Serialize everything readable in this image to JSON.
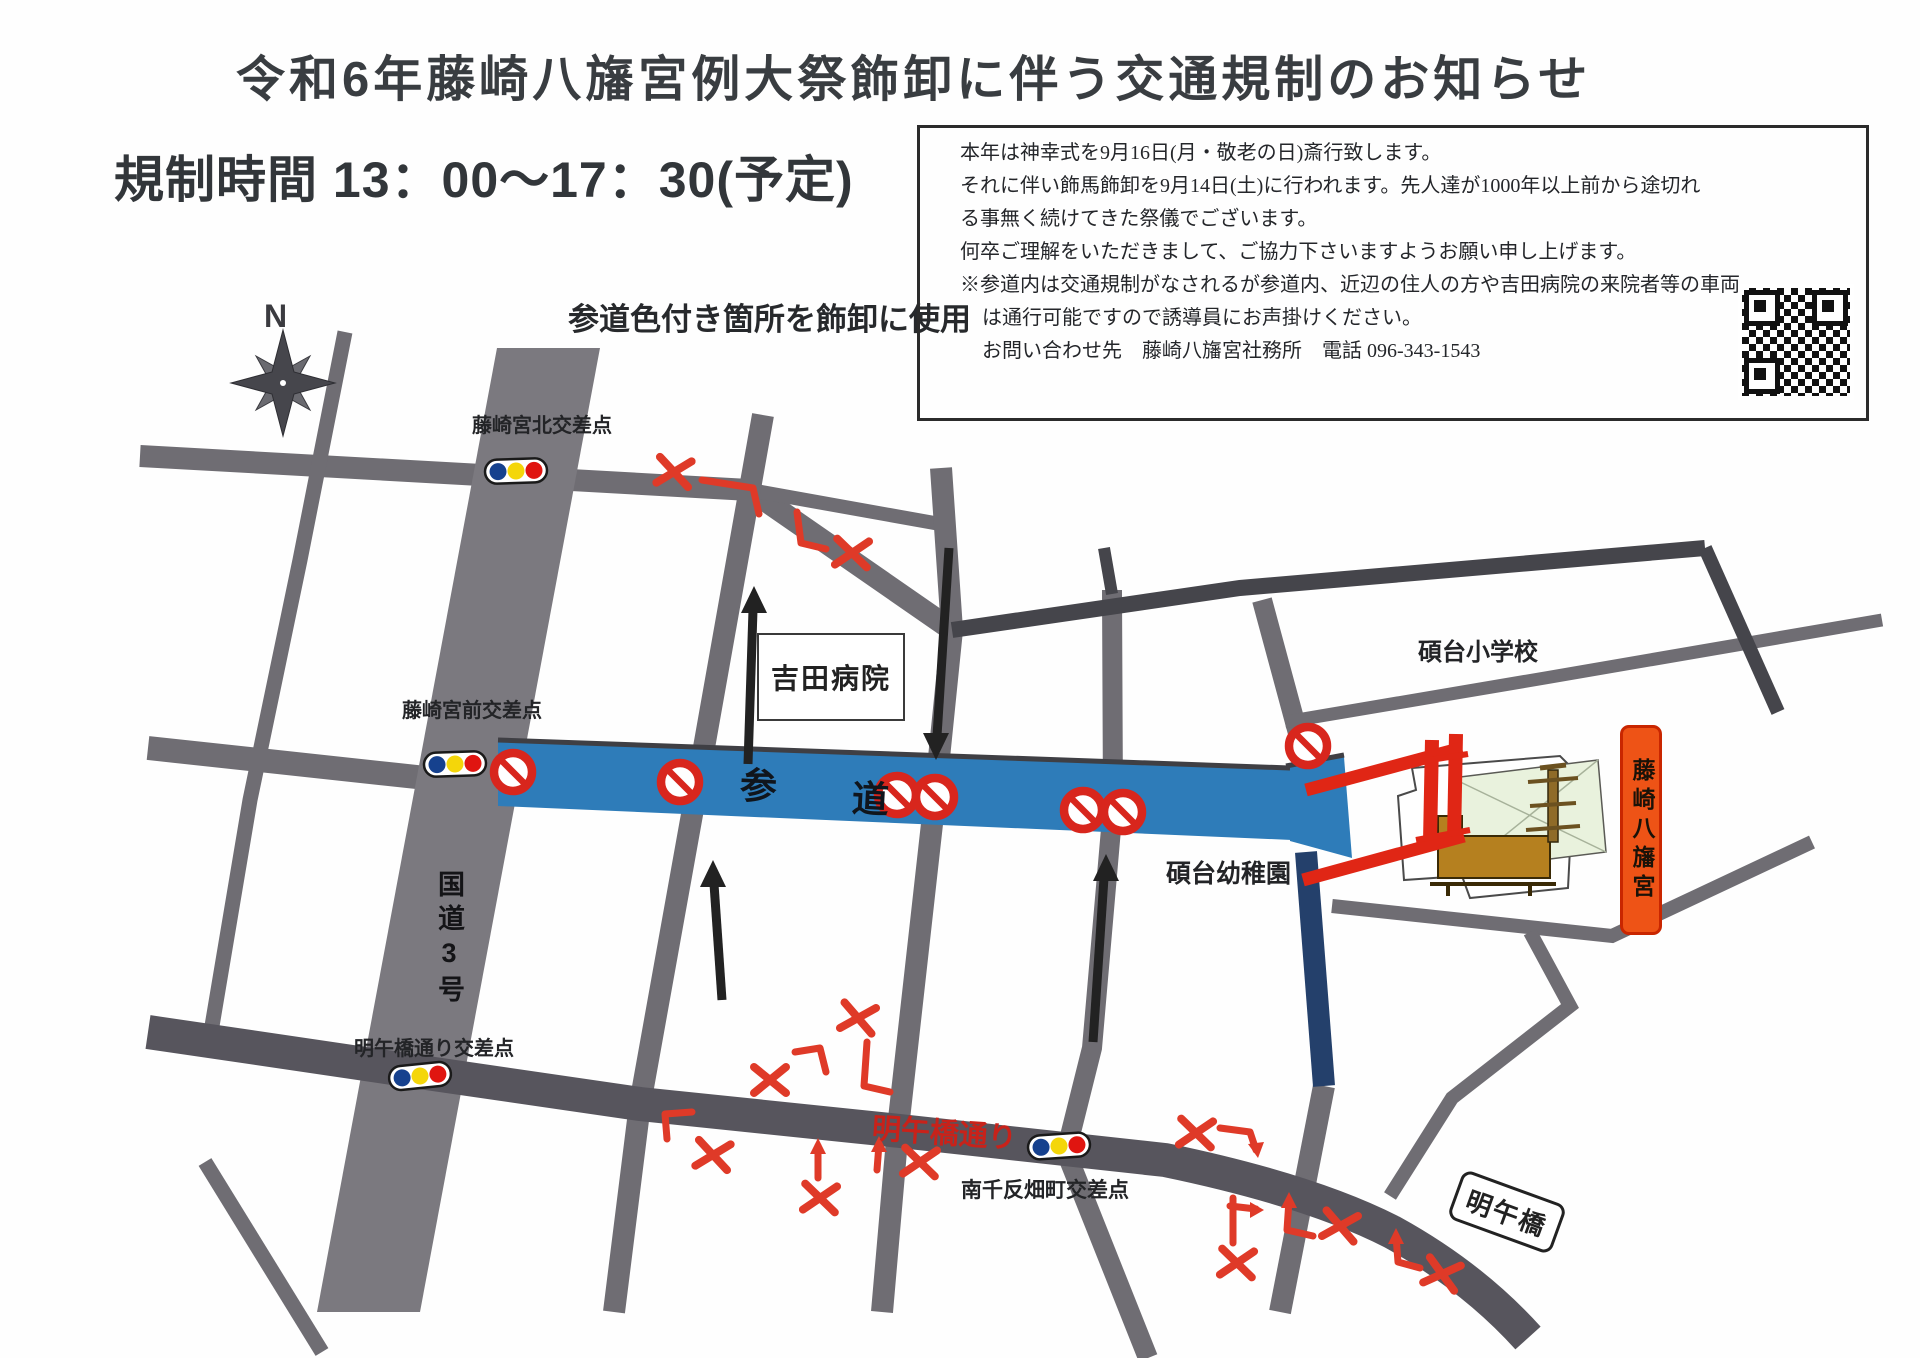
{
  "header": {
    "title": "令和6年藤崎八旛宮例大祭飾卸に伴う交通規制のお知らせ",
    "restriction_time": "規制時間 13：00～17：30(予定)"
  },
  "notice_box": {
    "line1": "本年は神幸式を9月16日(月・敬老の日)斎行致します。",
    "line2": "それに伴い飾馬飾卸を9月14日(土)に行われます。先人達が1000年以上前から途切れ",
    "line3": "る事無く続けてきた祭儀でございます。",
    "line4": "何卒ご理解をいただきまして、ご協力下さいますようお願い申し上げます。",
    "line5": "※参道内は交通規制がなされるが参道内、近辺の住人の方や吉田病院の来院者等の車両",
    "line6": "は通行可能ですので誘導員にお声掛けください。",
    "line7": "お問い合わせ先　藤崎八旛宮社務所　電話 096-343-1543"
  },
  "map": {
    "legend_note": "参道色付き箇所を飾卸に使用",
    "compass": "N",
    "intersections": {
      "north": "藤崎宮北交差点",
      "front": "藤崎宮前交差点",
      "meigobashi": "明午橋通り交差点",
      "minamisentanbata": "南千反畑町交差点"
    },
    "places": {
      "hospital": "吉田病院",
      "elementary": "碩台小学校",
      "kindergarten": "碩台幼稚園",
      "shrine": "藤崎八旛宮"
    },
    "roads": {
      "route3": "国道3号",
      "sando_a": "参",
      "sando_b": "道",
      "meigobashi_street": "明午橋通り",
      "meigo_bridge": "明午橋"
    },
    "colors": {
      "sando_blue": "#2e7cb9",
      "restricted_navy": "#24406b",
      "closure_red": "#df3a28",
      "no_entry_red": "#d8261d",
      "road_gray": "#716f75",
      "shrine_label_orange": "#ee5316"
    }
  }
}
